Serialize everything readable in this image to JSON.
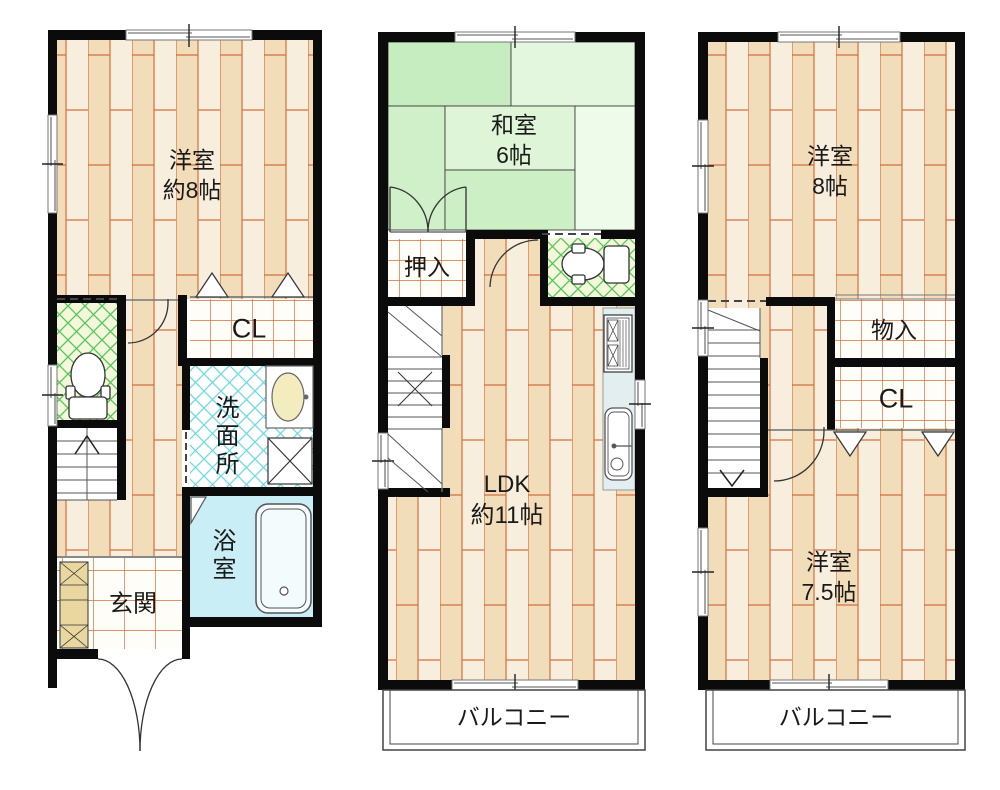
{
  "floor_plans": [
    {
      "name": "first-floor",
      "rooms": {
        "western_room": {
          "name_label": "洋室",
          "size_label": "約8帖"
        },
        "closet_label": "CL",
        "washroom_label": "洗面所",
        "bathroom_label": "浴室",
        "entrance_label": "玄関"
      }
    },
    {
      "name": "second-floor",
      "rooms": {
        "japanese_room": {
          "name_label": "和室",
          "size_label": "6帖"
        },
        "oshiire_label": "押入",
        "ldk": {
          "name_label": "LDK",
          "size_label": "約11帖"
        },
        "balcony_label": "バルコニー"
      }
    },
    {
      "name": "third-floor",
      "rooms": {
        "western_room_8": {
          "name_label": "洋室",
          "size_label": "8帖"
        },
        "storage_label": "物入",
        "closet_label": "CL",
        "western_room_7_5": {
          "name_label": "洋室",
          "size_label": "7.5帖"
        },
        "balcony_label": "バルコニー"
      }
    }
  ],
  "colors": {
    "wall": "#0b0b0b",
    "wood_floor_base": "#f8eedd",
    "wood_floor_dark": "#f1ddba",
    "wood_floor_line": "#d2703c",
    "tatami_green": "#c6edbf",
    "closet_grid_line": "#d2703c",
    "toilet_hatch": "#55c55c",
    "washroom_hatch": "#6fd9e2",
    "bathroom_fill": "#c9eef6",
    "kitchen_counter": "#e3eef1",
    "shoe_cabinet": "#e9d79f"
  }
}
